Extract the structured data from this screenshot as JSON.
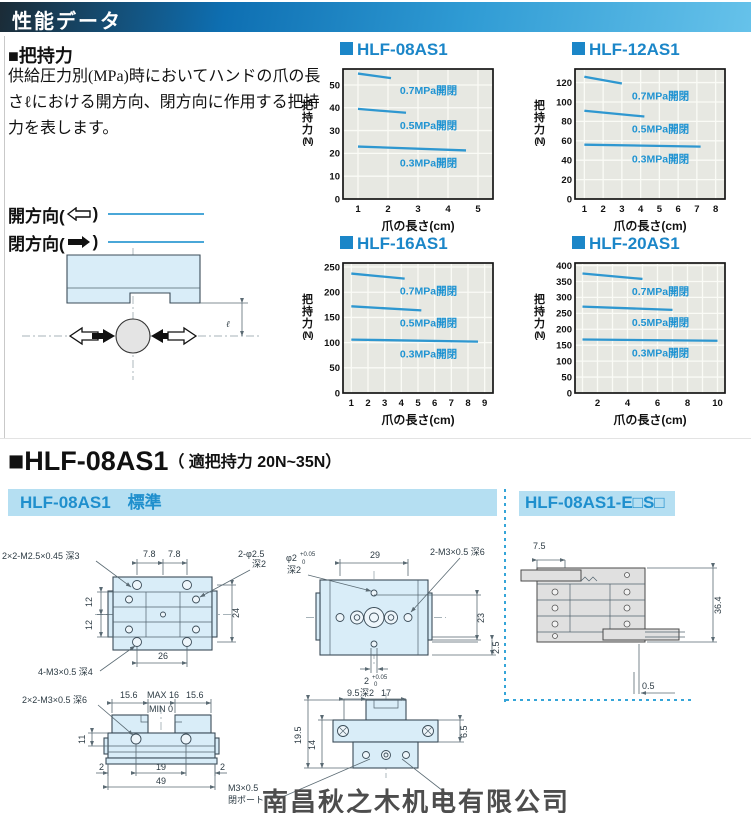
{
  "header": {
    "title": "性能データ"
  },
  "intro": {
    "heading": "■把持力",
    "body": "供給圧力別(MPa)時においてハンドの爪の長さℓにおける開方向、閉方向に作用する把持力を表します。",
    "legend": {
      "open_pre": "開方向(",
      "close_pre": "閉方向(",
      "suffix": ")"
    }
  },
  "diagram": {
    "ell": "ℓ"
  },
  "colors": {
    "accent_blue": "#1b86c8",
    "line": "#2e97d0",
    "series_label": "#1f93d2",
    "plot_bg": "#e7e8e2",
    "grid": "#fafbf6",
    "bar_bg": "#b5dff2",
    "bar_text": "#1f8fcd",
    "legend_line": "#4aa7d8"
  },
  "chart_data": [
    {
      "type": "line",
      "title": "HLF-08AS1",
      "xlabel": "爪の長さ(cm)",
      "ylabel": "把持力(N)",
      "xlim": [
        0.5,
        5.5
      ],
      "ylim": [
        0,
        57
      ],
      "xticks": [
        1,
        2,
        3,
        4,
        5
      ],
      "xlabels": [
        "1",
        "2",
        "3",
        "4",
        "5"
      ],
      "yticks": [
        0,
        10,
        20,
        30,
        40,
        50
      ],
      "series": [
        {
          "name": "0.7MPa開閉",
          "x": [
            1,
            2.1
          ],
          "y": [
            55,
            53
          ]
        },
        {
          "name": "0.5MPa開閉",
          "x": [
            1,
            2.6
          ],
          "y": [
            39.5,
            37.8
          ]
        },
        {
          "name": "0.3MPa開閉",
          "x": [
            1,
            4.6
          ],
          "y": [
            23,
            21.3
          ]
        }
      ]
    },
    {
      "type": "line",
      "title": "HLF-12AS1",
      "xlabel": "爪の長さ(cm)",
      "ylabel": "把持力(N)",
      "xlim": [
        0.5,
        8.5
      ],
      "ylim": [
        0,
        134
      ],
      "xticks": [
        1,
        2,
        3,
        4,
        5,
        6,
        7,
        8
      ],
      "xlabels": [
        "1",
        "2",
        "3",
        "4",
        "5",
        "6",
        "7",
        "8"
      ],
      "yticks": [
        0,
        20,
        40,
        60,
        80,
        100,
        120
      ],
      "series": [
        {
          "name": "0.7MPa開閉",
          "x": [
            1,
            3
          ],
          "y": [
            126,
            119
          ]
        },
        {
          "name": "0.5MPa開閉",
          "x": [
            1,
            4.2
          ],
          "y": [
            91,
            85
          ]
        },
        {
          "name": "0.3MPa開閉",
          "x": [
            1,
            7.2
          ],
          "y": [
            56,
            54
          ]
        }
      ]
    },
    {
      "type": "line",
      "title": "HLF-16AS1",
      "xlabel": "爪の長さ(cm)",
      "ylabel": "把持力(N)",
      "xlim": [
        0.5,
        9.5
      ],
      "ylim": [
        0,
        258
      ],
      "xticks": [
        1,
        2,
        3,
        4,
        5,
        6,
        7,
        8,
        9
      ],
      "xlabels": [
        "1",
        "2",
        "3",
        "4",
        "5",
        "6",
        "7",
        "8",
        "9"
      ],
      "yticks": [
        0,
        50,
        100,
        150,
        200,
        250
      ],
      "series": [
        {
          "name": "0.7MPa開閉",
          "x": [
            1,
            4.2
          ],
          "y": [
            237,
            227
          ]
        },
        {
          "name": "0.5MPa開閉",
          "x": [
            1,
            5.2
          ],
          "y": [
            172,
            164
          ]
        },
        {
          "name": "0.3MPa開閉",
          "x": [
            1,
            8.6
          ],
          "y": [
            106,
            102
          ]
        }
      ]
    },
    {
      "type": "line",
      "title": "HLF-20AS1",
      "xlabel": "爪の長さ(cm)",
      "ylabel": "把持力(N)",
      "xlim": [
        0.5,
        10.5
      ],
      "ylim": [
        0,
        408
      ],
      "xticks": [
        1,
        2,
        3,
        4,
        5,
        6,
        7,
        8,
        9,
        10
      ],
      "xlabels": [
        "",
        "2",
        "",
        "4",
        "",
        "6",
        "",
        "8",
        "",
        "10"
      ],
      "yticks": [
        0,
        50,
        100,
        150,
        200,
        250,
        300,
        350,
        400
      ],
      "series": [
        {
          "name": "0.7MPa開閉",
          "x": [
            1,
            5
          ],
          "y": [
            375,
            358
          ]
        },
        {
          "name": "0.5MPa開閉",
          "x": [
            1,
            7
          ],
          "y": [
            271,
            261
          ]
        },
        {
          "name": "0.3MPa開閉",
          "x": [
            1,
            10
          ],
          "y": [
            168,
            164
          ]
        }
      ]
    }
  ],
  "section": {
    "title": "■HLF-08AS1",
    "subtitle": "（ 適把持力 20N~35N）",
    "bar_left": "HLF-08AS1　標準",
    "bar_right": "HLF-08AS1-E□S□"
  },
  "drawings": {
    "top": {
      "thread_label": "2×2-M2.5×0.45 深3",
      "hole_label": "2-φ2.5",
      "hole_depth": "深2",
      "bottom_label": "4-M3×0.5 深4",
      "d78a": "7.8",
      "d78b": "7.8",
      "d12a": "12",
      "d12b": "12",
      "d24": "24",
      "d26": "26"
    },
    "plan": {
      "phi": "φ2",
      "tol_u": "+0.05",
      "tol_l": "0",
      "phi_depth": "深2",
      "d29": "29",
      "thread_label": "2-M3×0.5 深6",
      "d23": "23",
      "d25": "2.5",
      "d2": "2",
      "d2_tol_u": "+0.05",
      "d2_tol_l": "0",
      "d2_depth": "深2"
    },
    "front": {
      "thread_label": "2×2-M3×0.5 深6",
      "d156a": "15.6",
      "dmax": "MAX 16",
      "dmin": "MIN 0",
      "d156b": "15.6",
      "d11": "11",
      "d2a": "2",
      "d19": "19",
      "d2b": "2",
      "d49": "49"
    },
    "side": {
      "d95": "9.5",
      "d17": "17",
      "d195": "19.5",
      "d14": "14",
      "d65": "6.5",
      "port1": "M3×0.5",
      "port2": "閉ポート"
    },
    "e": {
      "d75": "7.5",
      "d364": "36.4",
      "d05": "0.5"
    }
  },
  "watermark": "南昌秋之木机电有限公司"
}
